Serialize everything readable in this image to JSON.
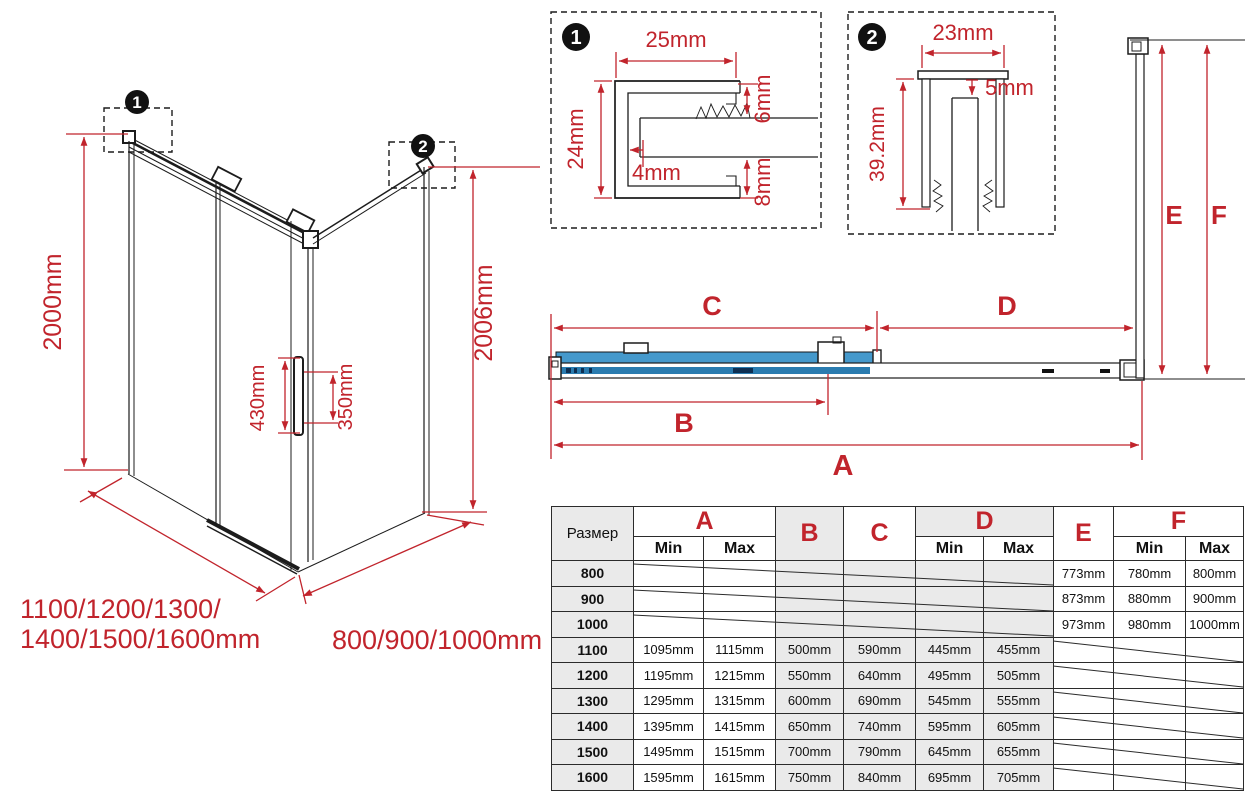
{
  "colors": {
    "red": "#c1242c",
    "blue_light": "#4599cc",
    "blue_dark": "#2a7cb0",
    "line_black": "#1c1c1c"
  },
  "perspective": {
    "marker1": "1",
    "marker2": "2",
    "dim_height_left": "2000mm",
    "dim_height_right": "2006mm",
    "dim_handle_left": "430mm",
    "dim_handle_right": "350mm",
    "dim_width_line1": "1100/1200/1300/",
    "dim_width_line2": "1400/1500/1600mm",
    "dim_depth": "800/900/1000mm"
  },
  "detail1": {
    "marker": "1",
    "dim_width": "25mm",
    "dim_height": "24mm",
    "dim_top_gap": "6mm",
    "dim_offset": "4mm",
    "dim_bottom_gap": "8mm"
  },
  "detail2": {
    "marker": "2",
    "dim_width": "23mm",
    "dim_top_gap": "5mm",
    "dim_height": "39.2mm"
  },
  "plan": {
    "dim_a": "A",
    "dim_b": "B",
    "dim_c": "C",
    "dim_d": "D",
    "dim_e": "E",
    "dim_f": "F"
  },
  "table": {
    "size_header": "Размер",
    "col_a": "A",
    "col_b": "B",
    "col_c": "C",
    "col_d": "D",
    "col_e": "E",
    "col_f": "F",
    "min": "Min",
    "max": "Max",
    "rows": [
      {
        "size": "800",
        "a_min": "",
        "a_max": "",
        "b": "",
        "c": "",
        "d_min": "",
        "d_max": "",
        "e": "773mm",
        "f_min": "780mm",
        "f_max": "800mm"
      },
      {
        "size": "900",
        "a_min": "",
        "a_max": "",
        "b": "",
        "c": "",
        "d_min": "",
        "d_max": "",
        "e": "873mm",
        "f_min": "880mm",
        "f_max": "900mm"
      },
      {
        "size": "1000",
        "a_min": "",
        "a_max": "",
        "b": "",
        "c": "",
        "d_min": "",
        "d_max": "",
        "e": "973mm",
        "f_min": "980mm",
        "f_max": "1000mm"
      },
      {
        "size": "1100",
        "a_min": "1095mm",
        "a_max": "1115mm",
        "b": "500mm",
        "c": "590mm",
        "d_min": "445mm",
        "d_max": "455mm",
        "e": "",
        "f_min": "",
        "f_max": ""
      },
      {
        "size": "1200",
        "a_min": "1195mm",
        "a_max": "1215mm",
        "b": "550mm",
        "c": "640mm",
        "d_min": "495mm",
        "d_max": "505mm",
        "e": "",
        "f_min": "",
        "f_max": ""
      },
      {
        "size": "1300",
        "a_min": "1295mm",
        "a_max": "1315mm",
        "b": "600mm",
        "c": "690mm",
        "d_min": "545mm",
        "d_max": "555mm",
        "e": "",
        "f_min": "",
        "f_max": ""
      },
      {
        "size": "1400",
        "a_min": "1395mm",
        "a_max": "1415mm",
        "b": "650mm",
        "c": "740mm",
        "d_min": "595mm",
        "d_max": "605mm",
        "e": "",
        "f_min": "",
        "f_max": ""
      },
      {
        "size": "1500",
        "a_min": "1495mm",
        "a_max": "1515mm",
        "b": "700mm",
        "c": "790mm",
        "d_min": "645mm",
        "d_max": "655mm",
        "e": "",
        "f_min": "",
        "f_max": ""
      },
      {
        "size": "1600",
        "a_min": "1595mm",
        "a_max": "1615mm",
        "b": "750mm",
        "c": "840mm",
        "d_min": "695mm",
        "d_max": "705mm",
        "e": "",
        "f_min": "",
        "f_max": ""
      }
    ]
  }
}
